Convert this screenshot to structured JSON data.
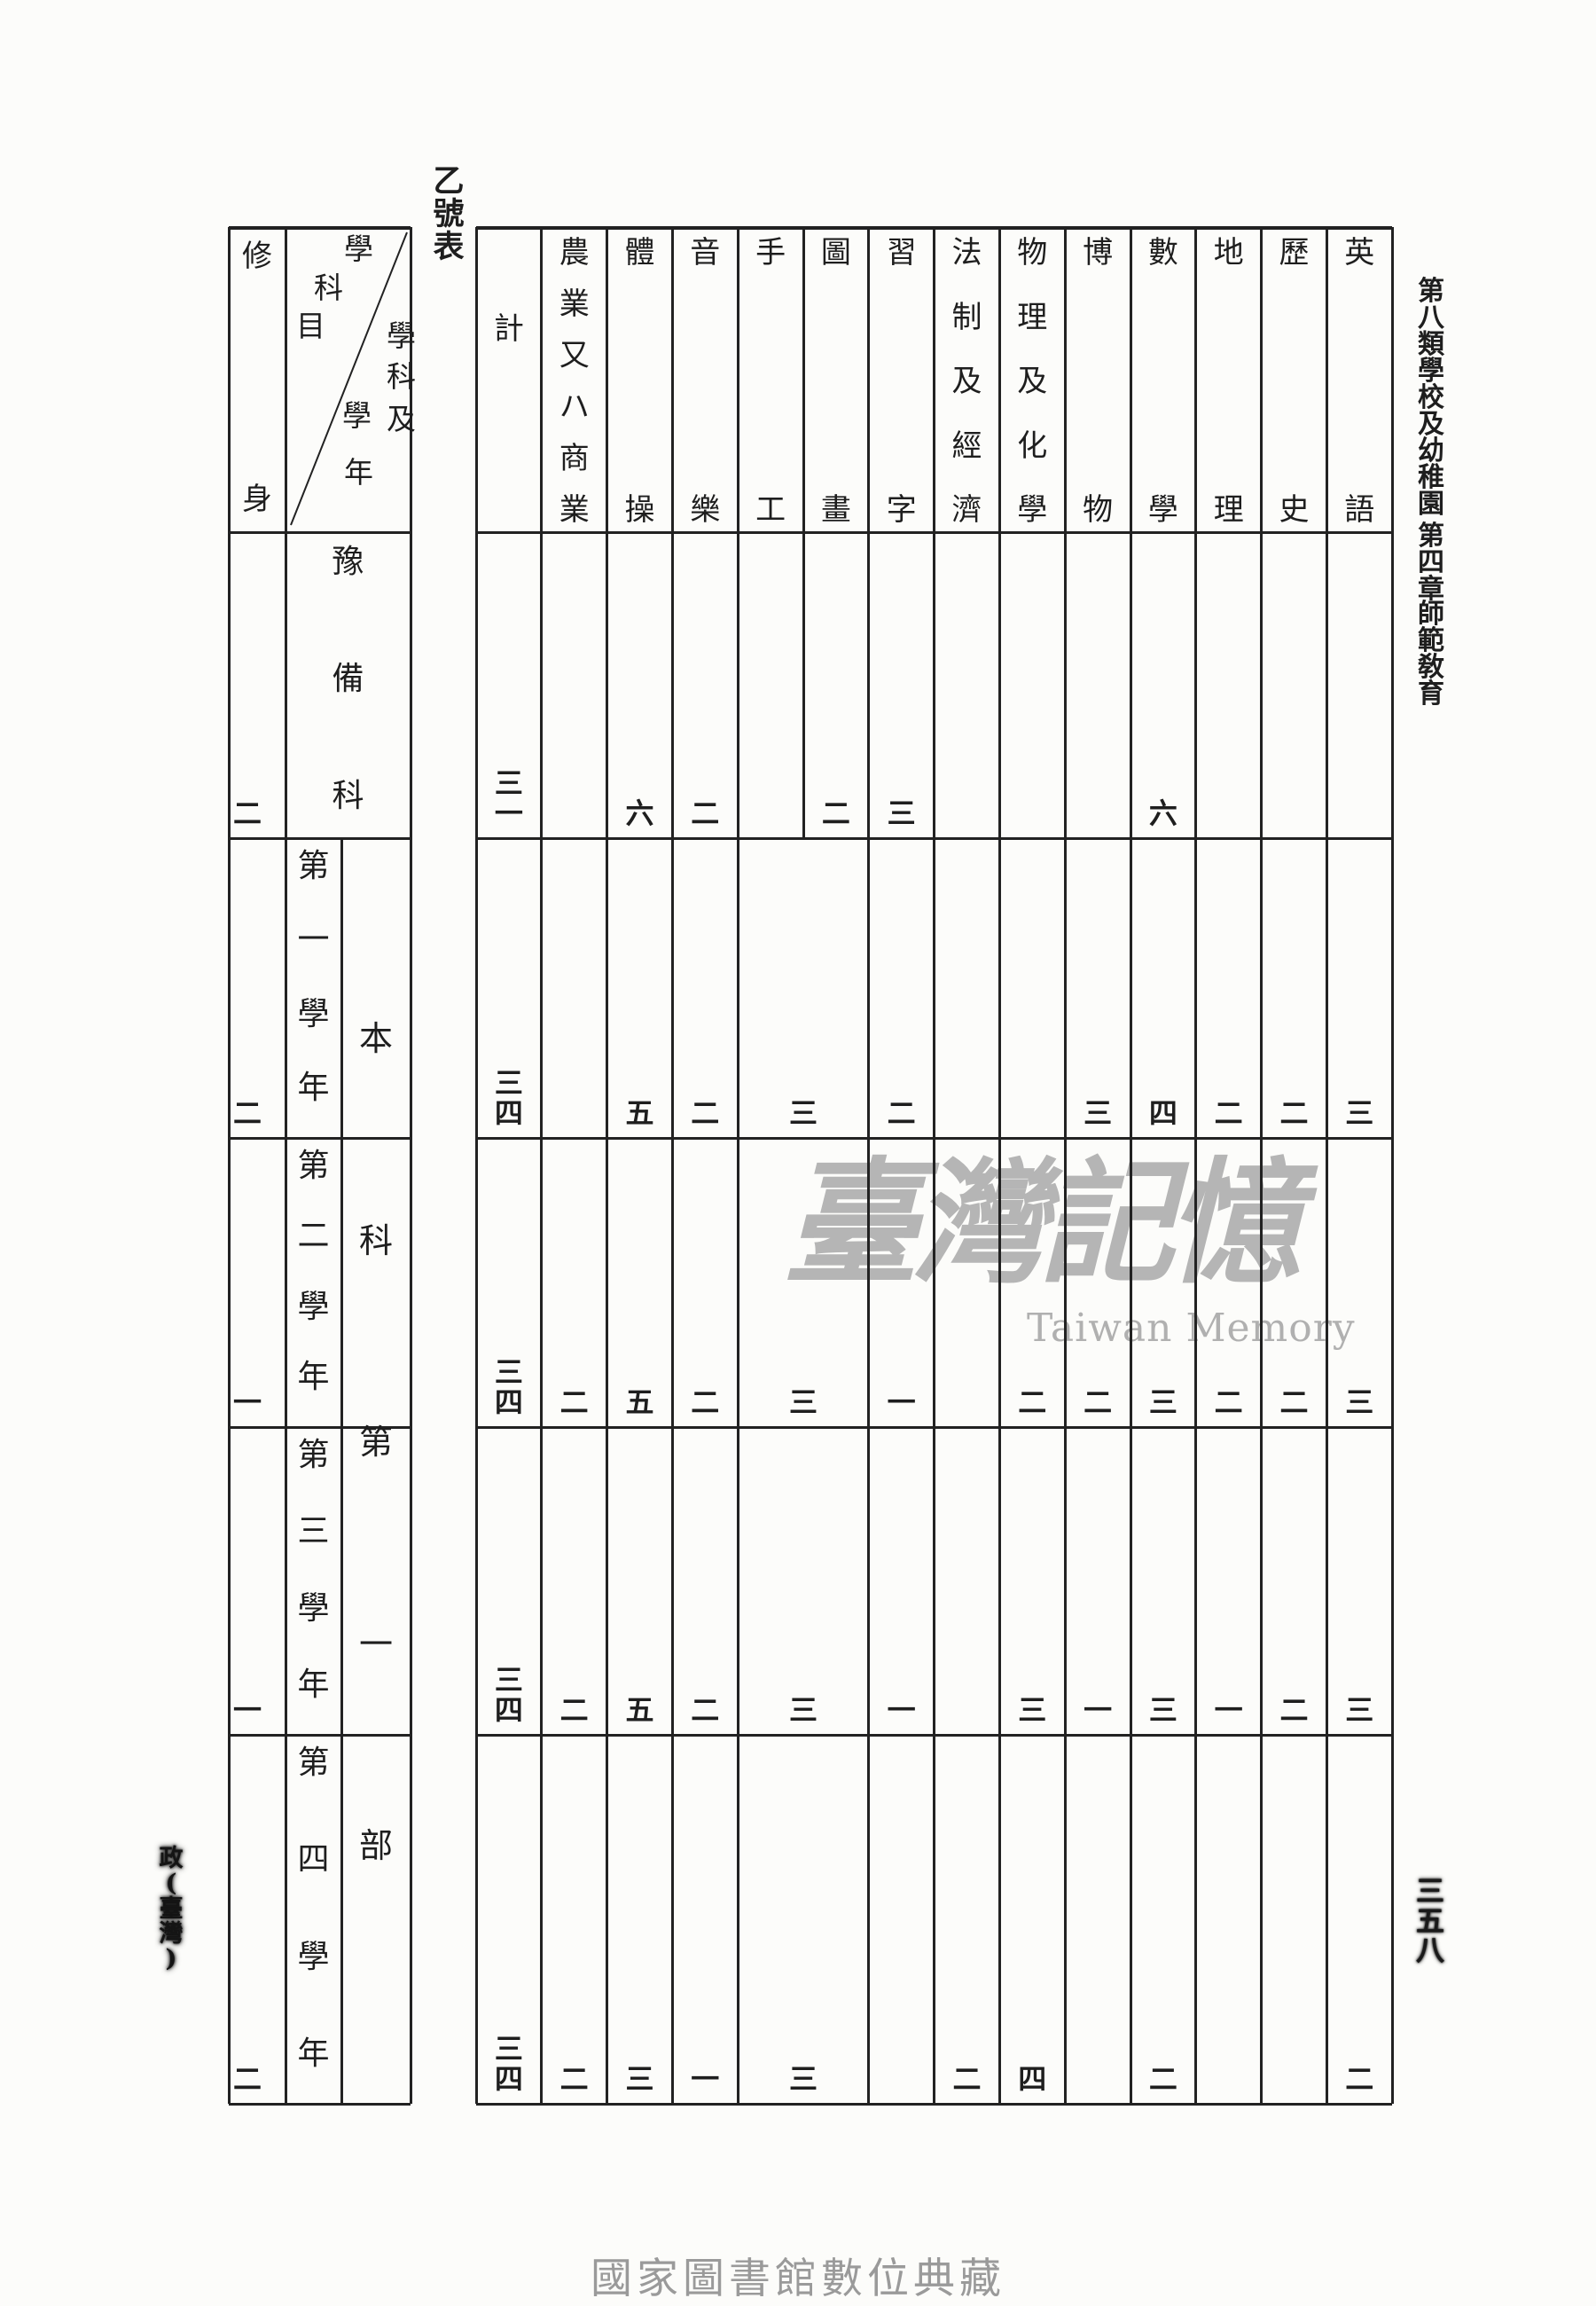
{
  "page": {
    "table_label": "乙號表",
    "side_caption": "第八類 學校及幼稚園 第四章 師範敎育",
    "side_caption_parts": [
      "第八類",
      "學校及幼稚園",
      "第四章",
      "師範敎育"
    ],
    "page_number": "三五八",
    "margin_note": "政(臺灣)",
    "watermark": {
      "cjk": "臺灣記憶",
      "latin": "Taiwan Memory"
    },
    "footer": "國家圖書館數位典藏",
    "ink_color": "#222222",
    "watermark_color": "#a8a8a8"
  },
  "table": {
    "corner": {
      "subjects_label": "學科目",
      "years_label": "學科及學年"
    },
    "first_column_header": "修身",
    "columns": [
      "計",
      "農業又ハ商業",
      "體操",
      "音樂",
      "手工",
      "圖畫",
      "習字",
      "法制及經濟",
      "物理及化學",
      "博物",
      "數學",
      "地理",
      "歷史",
      "英語"
    ],
    "group_label": "本科第一部",
    "rows": [
      {
        "label": "豫備科",
        "moral_training": "二",
        "merged_craft_drawing": "",
        "values": [
          "三一",
          "",
          "六",
          "二",
          "",
          "二",
          "三",
          "",
          "",
          "",
          "六",
          "",
          "",
          ""
        ]
      },
      {
        "label": "第一學年",
        "moral_training": "二",
        "merged_craft_drawing": "三",
        "values": [
          "三四",
          "",
          "五",
          "二",
          "",
          "",
          "二",
          "",
          "",
          "三",
          "四",
          "二",
          "二",
          "三"
        ]
      },
      {
        "label": "第二學年",
        "moral_training": "一",
        "merged_craft_drawing": "三",
        "values": [
          "三四",
          "二",
          "五",
          "二",
          "",
          "",
          "一",
          "",
          "二",
          "二",
          "三",
          "二",
          "二",
          "三"
        ]
      },
      {
        "label": "第三學年",
        "moral_training": "一",
        "merged_craft_drawing": "三",
        "values": [
          "三四",
          "二",
          "五",
          "二",
          "",
          "",
          "一",
          "",
          "三",
          "一",
          "三",
          "一",
          "二",
          "三"
        ]
      },
      {
        "label": "第四學年",
        "moral_training": "二",
        "merged_craft_drawing": "三",
        "values": [
          "三四",
          "二",
          "三",
          "一",
          "",
          "",
          "",
          "二",
          "四",
          "",
          "二",
          "",
          "",
          "二"
        ]
      }
    ]
  }
}
